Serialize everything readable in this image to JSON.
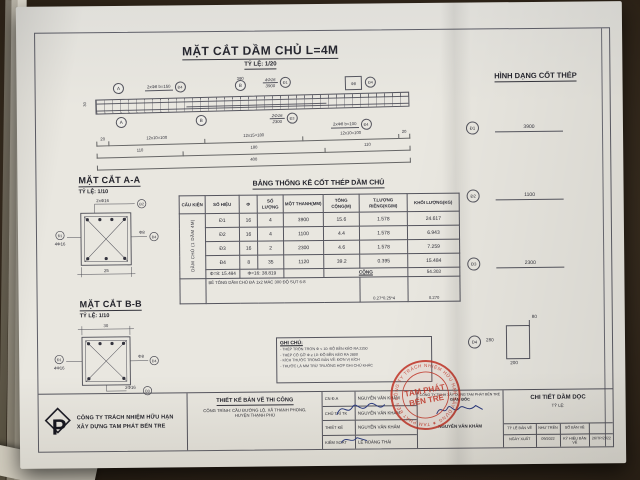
{
  "titles": {
    "main": "MẶT CẮT DẦM CHỦ L=4M",
    "main_scale": "TỶ LỆ: 1/20",
    "section_a": "MẶT CẮT A-A",
    "section_a_scale": "TỶ LỆ: 1/10",
    "section_b": "MẶT CẮT B-B",
    "section_b_scale": "TỶ LỆ: 1/10",
    "table": "BẢNG THỐNG KÊ CỐT THÉP DẦM CHỦ",
    "shapes": "HÌNH DẠNG CỐT THÉP"
  },
  "beam": {
    "dim_top": "390",
    "marker_a": "A",
    "marker_b": "B",
    "stirrup_left_label": "2xΦ8 b=150",
    "stirrup_left_ref": "Đ4",
    "top_bars_label": "4Φ16",
    "top_bars_len": "3900",
    "top_bars_ref": "Đ1",
    "hanger_label": "Φ8",
    "hanger_ref": "Đ4",
    "bottom_bars_label": "2Φ16",
    "bottom_bars_len": "2300",
    "bottom_bars_ref": "Đ3",
    "stirrup_right_label": "2xΦ8 b=100",
    "stirrup_right_ref": "Đ4",
    "dim_end_left": "20",
    "dim_end_right": "20",
    "dims_row1": [
      "12x10=100",
      "12x15=180",
      "12x10=100"
    ],
    "dims_row2": [
      "110",
      "180",
      "110"
    ],
    "dim_total": "400",
    "dim_height": "30"
  },
  "section_a": {
    "callout_top": "2xΦ16",
    "callout_top_ref": "Đ2",
    "callout_left": "4Φ16",
    "callout_left_ref": "Đ1",
    "callout_right": "Φ8",
    "callout_right_ref": "Đ4",
    "dim_bottom": "25"
  },
  "section_b": {
    "dim_top": "30",
    "callout_left": "4Φ16",
    "callout_left_ref": "Đ1",
    "callout_right": "Φ8",
    "callout_right_ref": "Đ4",
    "callout_bottom": "2Φ16",
    "callout_bottom_ref": "Đ3"
  },
  "table": {
    "headers": [
      "CẤU KIỆN",
      "SỐ HIỆU",
      "Φ",
      "SỐ LƯỢNG",
      "MỘT THANH(MM)",
      "TỔNG CỘNG(M)",
      "T.LƯỢNG RIÊNG(KG/M)",
      "KHỐI LƯỢNG(KG)"
    ],
    "group_label": "DẦM CHỦ (1 DẦM 4M)",
    "rows": [
      [
        "Đ1",
        "16",
        "4",
        "3900",
        "15.6",
        "1.578",
        "24.617"
      ],
      [
        "Đ2",
        "16",
        "4",
        "1100",
        "4.4",
        "1.578",
        "6.943"
      ],
      [
        "Đ3",
        "16",
        "2",
        "2300",
        "4.6",
        "1.578",
        "7.259"
      ],
      [
        "Đ4",
        "8",
        "35",
        "1120",
        "39.2",
        "0.395",
        "15.484"
      ]
    ],
    "subtotal": {
      "phi8": "Φ=8: 15.484",
      "phi16": "Φ=16: 38.819",
      "total_label": "CỘNG",
      "total_value": "54.303"
    },
    "concrete": {
      "note": "BÊ TÔNG DẦM CHỦ ĐÁ 1x2 MÁC 300 ĐỘ SỤT 6-8",
      "calc": "0.27*0.25*4",
      "value": "0.270"
    }
  },
  "shapes": [
    {
      "id": "Đ1",
      "length": "3900"
    },
    {
      "id": "Đ2",
      "length": "1100"
    },
    {
      "id": "Đ3",
      "length": "2300"
    },
    {
      "id": "Đ4",
      "dim_left": "280",
      "dim_bottom": "200",
      "dim_hook": "80"
    }
  ],
  "notes": {
    "title": "GHI CHÚ:",
    "lines": [
      "- THÉP TRÒN TRƠN Φ < 10: ĐỘ BỀN KÉO RA 2250",
      "- THÉP CÓ GỜ Φ ≥ 10: ĐỘ BỀN KÉO RA 2800",
      "- KÍCH THƯỚC TRONG BẢN VẼ: ĐƠN VỊ KÍCH",
      "- THƯỚC LÀ MM TRỪ TRƯỜNG HỢP GHI CHÚ KHÁC"
    ]
  },
  "titleblock": {
    "company_line1": "CÔNG TY TRÁCH NHIỆM HỮU HẠN",
    "company_line2": "XÂY DỰNG TAM PHÁT BẾN TRE",
    "doc_type": "THIẾT KẾ BẢN VẼ THI CÔNG",
    "project_line1": "CÔNG TRÌNH: CẦU ĐƯỜNG LỘ, XÃ THẠNH PHONG,",
    "project_line2": "HUYỆN THẠNH PHÚ",
    "roles": [
      {
        "label": "CN Đ.A",
        "name": "NGUYỄN VĂN KHẢM"
      },
      {
        "label": "CHỦ TRÌ TK",
        "name": "NGUYỄN VĂN KHẢM"
      },
      {
        "label": "THIẾT KẾ",
        "name": "NGUYỄN VĂN KHẢM"
      },
      {
        "label": "KIỂM SOÁT",
        "name": "LÊ HOÀNG THÁI"
      }
    ],
    "approver_company": "CÔNG TY TNHH XÂY DỰNG TAM PHÁT BẾN TRE",
    "approver_title": "GIÁM ĐỐC",
    "approver_name": "NGUYỄN VĂN KHẢM",
    "stamp": {
      "ring_text": "CÔNG TY TRÁCH NHIỆM HỮU HẠN XÂY DỰNG ★ TAM PHÁT BẾN TRE ★",
      "center_line1": "TAM PHÁT",
      "center_line2": "BẾN TRE"
    },
    "drawing_title": "CHI TIẾT DẦM DỌC",
    "drawing_scale": "TỶ LỆ:",
    "info_grid": [
      [
        "TỶ LỆ BẢN VẼ",
        "NHƯ TRÊN",
        "SỐ BẢN VẼ",
        ""
      ],
      [
        "NGÀY XUẤT",
        "09/2022",
        "KÝ HIỆU BẢN VẼ",
        "26/TP/2022"
      ]
    ]
  }
}
